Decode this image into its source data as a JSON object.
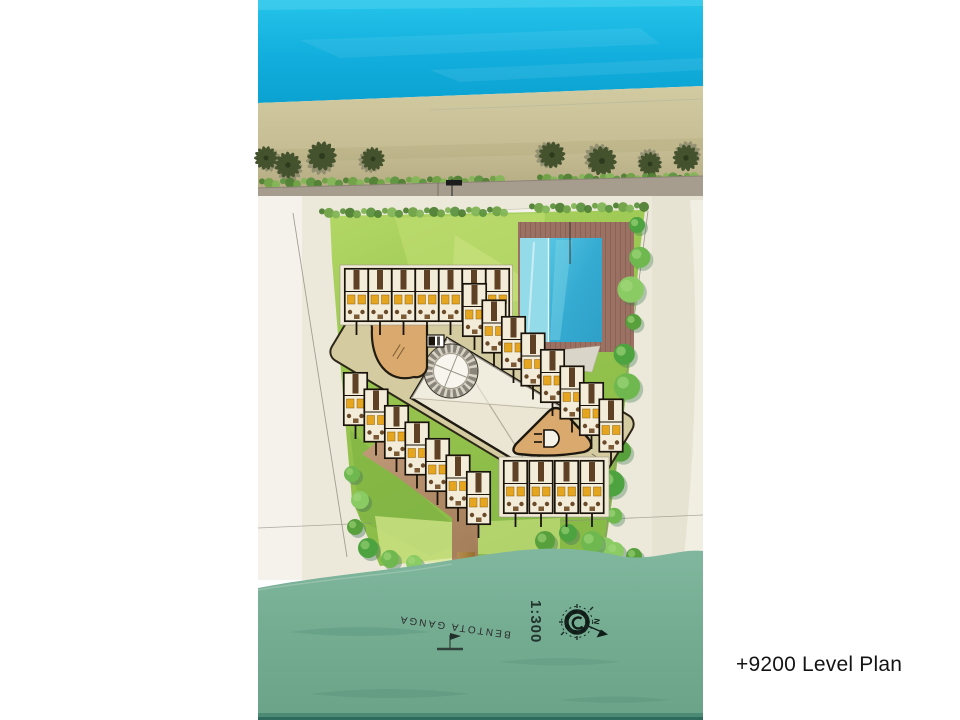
{
  "title_block": {
    "caption": "+9200 Level Plan"
  },
  "map": {
    "river_label": "BENTOTA GANGA",
    "scale_label": "1:300",
    "compass_north_label": "N",
    "section_marker_label": "A"
  },
  "legend_semantics": {
    "water_top": "sea",
    "water_bottom": "river",
    "buildings": "guest unit rows with lobby, circular stair and pool"
  },
  "colors": {
    "ocean": "#14b4e0",
    "sand": "#c8bf97",
    "road": "#a69d8e",
    "lawn": "#9cc84f",
    "site_ground": "#ece8da",
    "pool": "#3db2d8",
    "pool_shallow": "#93dbe9",
    "deck": "#9b7164",
    "river": "#76ae94",
    "jetty": "#ab8451",
    "path": "#b98a6f",
    "corridor": "#d4cba1",
    "building_tan": "#d9a96d",
    "unit_floor": "#f2ecd9",
    "unit_accent": "#e6a51f",
    "tree": "#57a649",
    "palm": "#44522d",
    "ink": "#19130a"
  }
}
